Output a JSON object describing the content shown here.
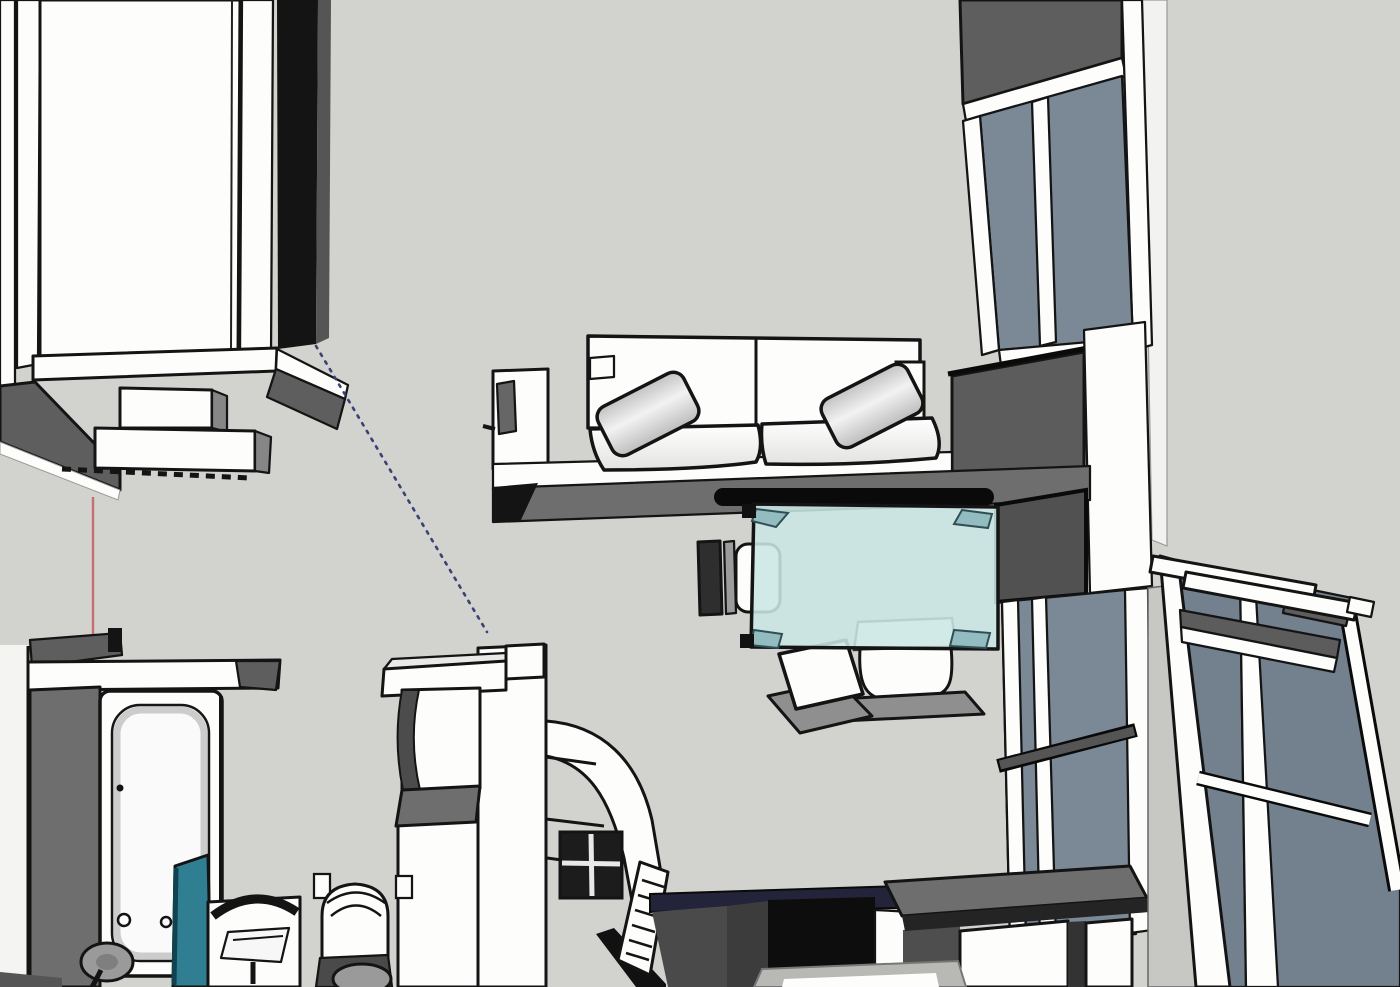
{
  "viewport": {
    "app_context": "3d-model-viewport",
    "scene_label": "apartment-top-down-cutaway"
  },
  "palette": {
    "background": "#d2d2cf",
    "outline": "#141414",
    "wall_shadow": "#5e5e5e",
    "wall_medium": "#6e6e6e",
    "wall_dark_panel": "#515151",
    "glass_window": "#7b8996",
    "glass_door": "#73818e",
    "glass_table": "#cbe6e4",
    "glass_table_corner": "#93bcc0",
    "shower_teal": "#2f7e92",
    "axis_red": "#c4706d",
    "guide_blue": "#3a4273",
    "counter_navy": "#23233a",
    "floor_light": "#b8b8b4",
    "fixture_gray": "#9a9a9a",
    "black": "#0a0a0a",
    "white": "#fdfdfc"
  },
  "scene": {
    "objects": [
      {
        "id": "entry-door",
        "label": "entry door leaf with frame"
      },
      {
        "id": "door-radiator",
        "label": "radiator boxes under sill"
      },
      {
        "id": "axis-line-red",
        "label": "red construction axis line"
      },
      {
        "id": "guide-line-blue",
        "label": "blue dotted guide line"
      },
      {
        "id": "bathroom",
        "label": "bathroom: bathtub, shower screen, sink, vanity, toilet"
      },
      {
        "id": "hall-wall",
        "label": "hall wall with niche, ledge and arched opening"
      },
      {
        "id": "sofa",
        "label": "white two-seat sofa with pillows"
      },
      {
        "id": "glass-table",
        "label": "teal glass dining table"
      },
      {
        "id": "chairs",
        "label": "four dining chairs"
      },
      {
        "id": "window-wall",
        "label": "tall window wall with spandrel and pillar"
      },
      {
        "id": "tv-panel",
        "label": "dark wall panel"
      },
      {
        "id": "kitchen-counter",
        "label": "kitchen counter with cabinets"
      },
      {
        "id": "balcony-door",
        "label": "tilted open balcony door"
      }
    ]
  }
}
